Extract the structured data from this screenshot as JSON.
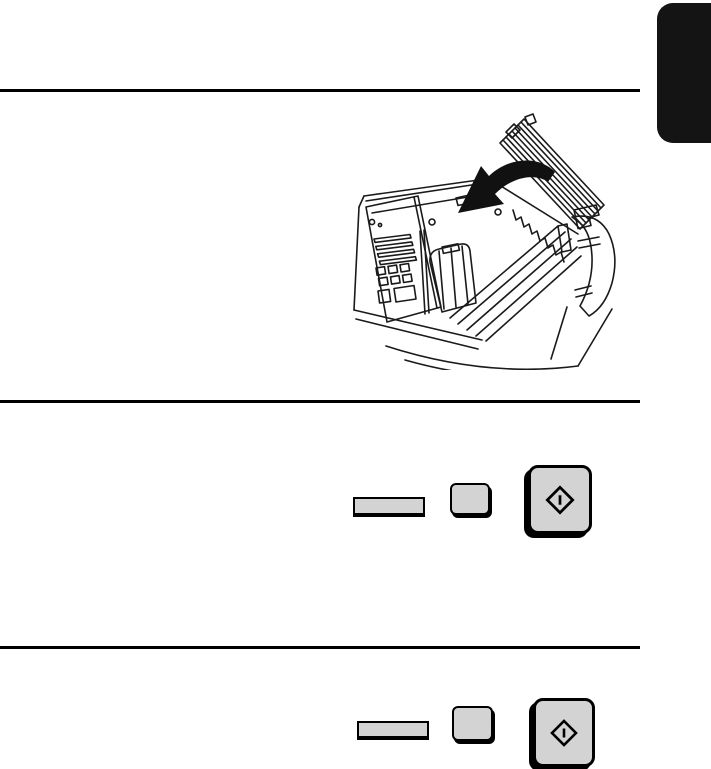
{
  "page": {
    "type": "manual-page-graphics-only",
    "background": "#ffffff",
    "index_tab": {
      "color": "#141414",
      "position": "top-right"
    },
    "dividers": {
      "color": "#000000",
      "count": 3
    },
    "illustration": {
      "name": "closing-print-compartment-cover",
      "subject": "fax-machine-line-drawing",
      "arrow_direction": "down-left",
      "elements": [
        "open-cover",
        "cover-latches",
        "hinge-bracket",
        "right-side-flap",
        "control-panel",
        "panel-stripes",
        "panel-keypad-squares",
        "print-carriage",
        "platen-rails",
        "spring-zigzag",
        "curved-black-arrow",
        "front-body-curves"
      ]
    },
    "key_rows": [
      {
        "id": "step-middle",
        "keys": [
          {
            "name": "function-key",
            "shape": "flat-bar",
            "label": ""
          },
          {
            "name": "selector-key",
            "shape": "small-rounded",
            "label": ""
          },
          {
            "name": "start-key",
            "shape": "large-rounded",
            "icon": "start-diamond-icon",
            "label": ""
          }
        ]
      },
      {
        "id": "step-bottom",
        "keys": [
          {
            "name": "function-key",
            "shape": "flat-bar",
            "label": ""
          },
          {
            "name": "selector-key",
            "shape": "small-rounded",
            "label": ""
          },
          {
            "name": "start-key",
            "shape": "large-rounded",
            "icon": "start-diamond-icon",
            "label": ""
          }
        ]
      }
    ],
    "colors": {
      "key_fill": "#d3d3d3",
      "key_border": "#000000",
      "line_art": "#1a1a1a",
      "arrow_fill": "#111111"
    }
  }
}
